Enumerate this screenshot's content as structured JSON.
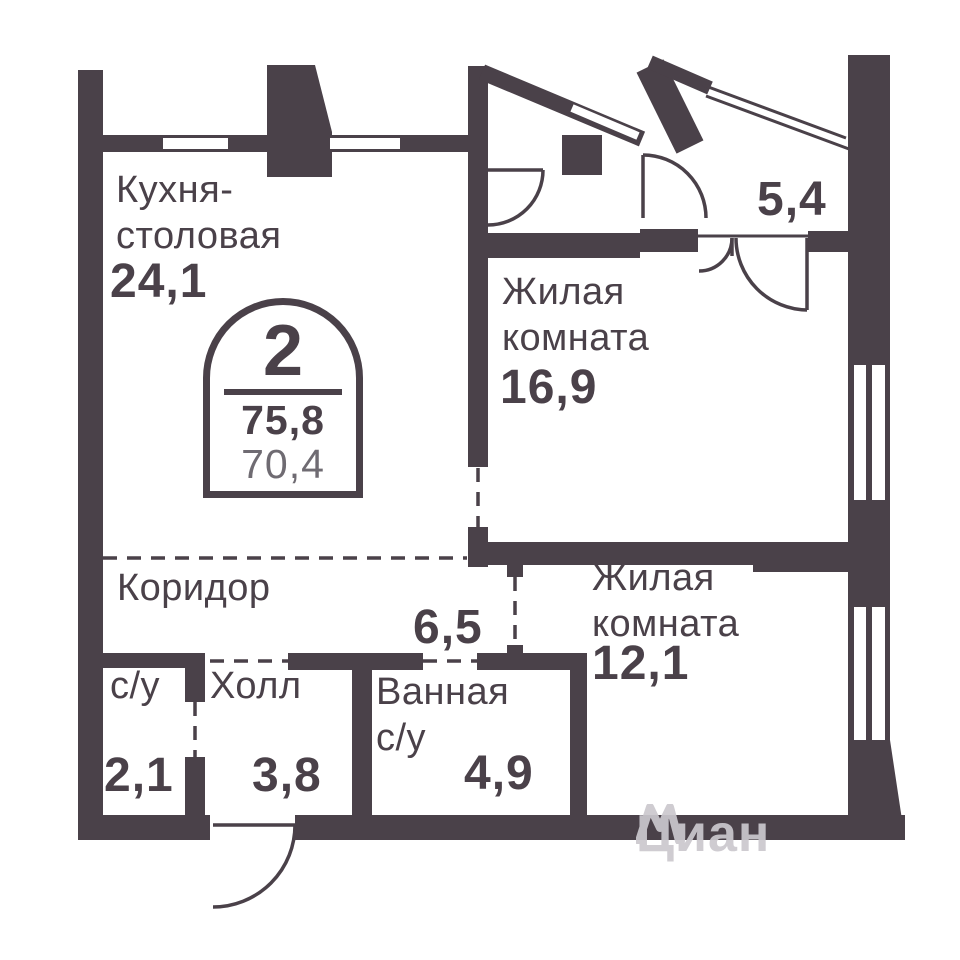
{
  "colors": {
    "wall": "#4a4149",
    "muted": "#6f6b72",
    "watermark": "#cbc8ce"
  },
  "stamp": {
    "rooms_count": "2",
    "total_area": "75,8",
    "living_area": "70,4"
  },
  "rooms": {
    "kitchen": {
      "name": "Кухня-\nстоловая",
      "area": "24,1"
    },
    "living1": {
      "name": "Жилая\nкомната",
      "area": "16,9"
    },
    "balcony": {
      "area": "5,4"
    },
    "corridor": {
      "name": "Коридор",
      "area": "6,5"
    },
    "wc": {
      "name": "с/у",
      "area": "2,1"
    },
    "hall": {
      "name": "Холл",
      "area": "3,8"
    },
    "bathroom": {
      "name": "Ванная\nс/у",
      "area": "4,9"
    },
    "living2": {
      "name": "Жилая\nкомната",
      "area": "12,1"
    }
  },
  "watermark": {
    "text": "Циан"
  }
}
